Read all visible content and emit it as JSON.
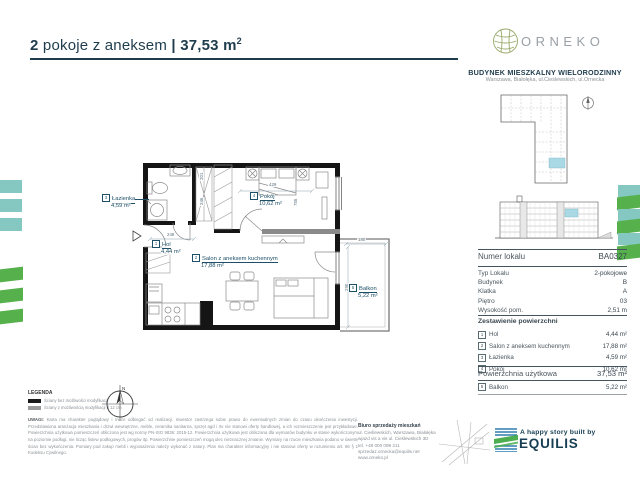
{
  "header": {
    "title_count": "2",
    "title_rooms": "pokoje z aneksem",
    "title_sep": "|",
    "title_area": "37,53 m",
    "title_area_sup": "2",
    "brand": "ORNEKO",
    "building_title": "BUDYNEK MIESZKALNY WIELORODZINNY",
    "building_subtitle": "Warszawa, Białołęka, ul.Cieślewskich, ul.Ornecka"
  },
  "sidebar": {
    "unit_number_label": "Numer lokalu",
    "unit_number": "BA0327",
    "details": [
      {
        "label": "Typ Lokalu",
        "value": "2-pokojowe"
      },
      {
        "label": "Budynek",
        "value": "B"
      },
      {
        "label": "Klatka",
        "value": "A"
      },
      {
        "label": "Piętro",
        "value": "03"
      },
      {
        "label": "Wysokość pom.",
        "value": "2,51 m"
      }
    ],
    "areas_title": "Zestawienie powierzchni",
    "areas": [
      {
        "num": "1",
        "label": "Hol",
        "value": "4,44 m²"
      },
      {
        "num": "2",
        "label": "Salon z aneksem kuchennym",
        "value": "17,88 m²"
      },
      {
        "num": "3",
        "label": "Łazienka",
        "value": "4,59 m²"
      },
      {
        "num": "4",
        "label": "Pokój",
        "value": "10,62 m²"
      }
    ],
    "total_label": "Powierzchnia użytkowa",
    "total_value": "37,53 m²",
    "balcony": {
      "num": "5",
      "label": "Balkon",
      "value": "5,22 m²"
    }
  },
  "plan": {
    "rooms": [
      {
        "num": "1",
        "name": "Hol",
        "area": "4,44 m²",
        "left": 152,
        "top": 240,
        "leader": false
      },
      {
        "num": "2",
        "name": "Salon z aneksem kuchennym",
        "area": "17,88 m²",
        "left": 192,
        "top": 254,
        "leader": false
      },
      {
        "num": "3",
        "name": "Łazienka",
        "area": "4,59 m²",
        "left": 102,
        "top": 193,
        "leader": true
      },
      {
        "num": "4",
        "name": "Pokój",
        "area": "10,62 m²",
        "left": 250,
        "top": 192,
        "leader": false
      },
      {
        "num": "5",
        "name": "Balkon",
        "area": "5,22 m²",
        "left": 349,
        "top": 284,
        "leader": false
      }
    ],
    "dims": [
      {
        "v": "429",
        "x": 268,
        "y": 182,
        "rot": 0
      },
      {
        "v": "755",
        "x": 293,
        "y": 207,
        "rot": -90
      },
      {
        "v": "246",
        "x": 199,
        "y": 206,
        "rot": -90
      },
      {
        "v": "201",
        "x": 199,
        "y": 181,
        "rot": -90
      },
      {
        "v": "248",
        "x": 166,
        "y": 232,
        "rot": 0
      },
      {
        "v": "180",
        "x": 357,
        "y": 237,
        "rot": 0
      },
      {
        "v": "290",
        "x": 344,
        "y": 292,
        "rot": -90
      }
    ]
  },
  "decor": {
    "stripes": [
      {
        "x": 0,
        "y": 180,
        "w": 22,
        "h": 13,
        "c": "teal"
      },
      {
        "x": 0,
        "y": 199,
        "w": 22,
        "h": 13,
        "c": "teal"
      },
      {
        "x": 0,
        "y": 218,
        "w": 22,
        "h": 13,
        "c": "teal"
      },
      {
        "x": 0,
        "y": 268,
        "w": 23,
        "h": 13,
        "c": "green"
      },
      {
        "x": 0,
        "y": 289,
        "w": 23,
        "h": 13,
        "c": "green"
      },
      {
        "x": 0,
        "y": 310,
        "w": 23,
        "h": 13,
        "c": "green"
      },
      {
        "x": 618,
        "y": 185,
        "w": 22,
        "h": 12,
        "c": "teal"
      },
      {
        "x": 617,
        "y": 196,
        "w": 23,
        "h": 13,
        "c": "green"
      },
      {
        "x": 618,
        "y": 209,
        "w": 22,
        "h": 12,
        "c": "teal"
      },
      {
        "x": 617,
        "y": 220,
        "w": 23,
        "h": 13,
        "c": "green"
      },
      {
        "x": 618,
        "y": 233,
        "w": 22,
        "h": 12,
        "c": "teal"
      },
      {
        "x": 617,
        "y": 245,
        "w": 23,
        "h": 14,
        "c": "green"
      }
    ]
  },
  "footer": {
    "legend_title": "LEGENDA",
    "legend_items": [
      "Ściany bez możliwości modyfikacji",
      "Ściany z możliwością modyfikacji d 12 cm"
    ],
    "uwagi_label": "UWAGI:",
    "uwagi_text": "Karta ma charakter poglądowy i może odbiegać od realizacji. Inwestor zastrzega sobie prawo do ewentualnych zmian do czasu ukończenia inwestycji. Przedstawiona aranżacja mieszkania i drzwi wewnętrzne, meble, ceramika sanitarna, sprzęt agd i rtv nie stanowi oferty handlowej, a ich rozmieszczenie jest przykładowe. Powierzchnia użytkowa pomieszczeń obliczona jest wg normy PN-ISO 9836: 2015-12. Powierzchnia użytkowa jest obliczana dla wymiarów budynku w stanie wykończonym na poziomie podłogi, nie licząc listew podłogowych, progów itp. Powierzchnie pomieszczeń mogą ulec nieznacznej zmianie. Wymiary na rzucie mieszkania podano w świetle ścian bez wykończenia. Pomiary pod zakup mebli i wyposażenia należy wykonać z natury. Plan ma charakter informacyjny i nie stanowi oferty w rozumieniu art. 66 § 1 Kodeksu Cywilnego.",
    "office_title": "Biuro sprzedaży mieszkań",
    "office_lines": [
      "ul. Cieślewskich, Warszawa, Białołęka",
      "wjazd vis a vis ul. Cieślewskich 3D",
      "tel. +48 000 099 211",
      "sprzedaz.ornecka@equilis.net",
      "www.orneko.pl"
    ],
    "equilis_tagline": "A happy story built by",
    "equilis_name": "EQUILIS"
  },
  "colors": {
    "navy": "#1f3c4d",
    "teal_stripe": "#85c8c1",
    "green_stripe": "#56b04b",
    "highlight_blue": "#a9d9e5",
    "orneko_green": "#97a868",
    "orneko_gray": "#9aa0a6",
    "label_blue": "#1d4f66",
    "equilis_navy": "#173e53",
    "equilis_green": "#4cae4f",
    "equilis_blue": "#2e7fae"
  }
}
